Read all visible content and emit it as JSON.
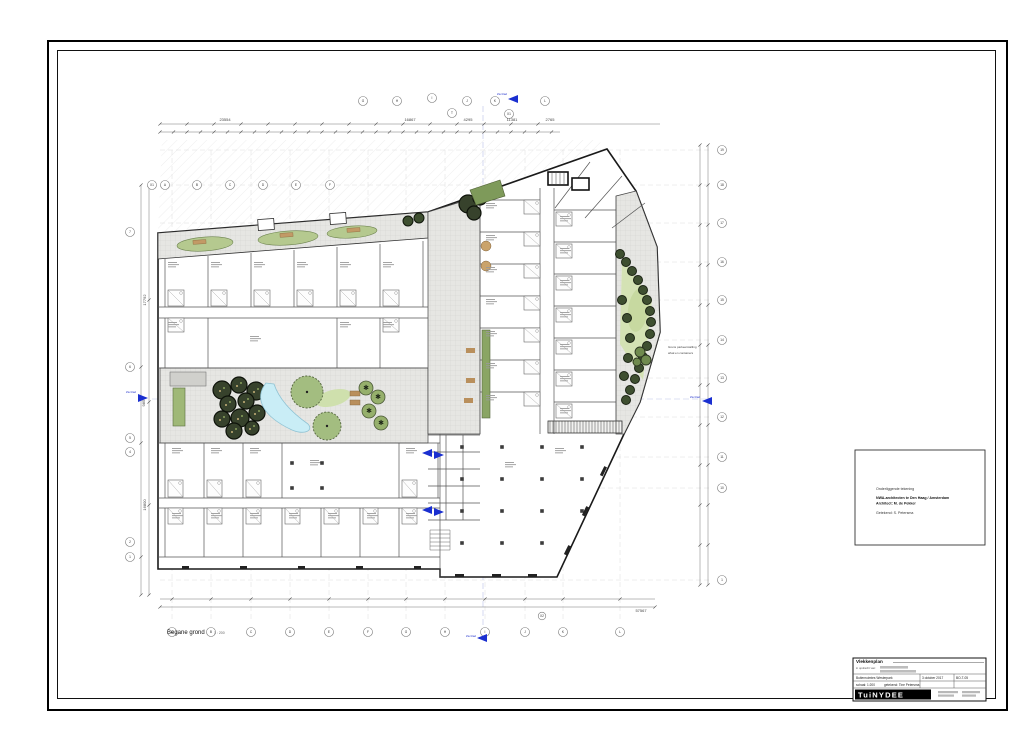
{
  "sheet": {
    "plan_title": "Begane grond",
    "plan_scale": "1 : 200"
  },
  "note_box": {
    "line1": "Onderliggende tekening",
    "line2": "NWA-architecten te Den Haag / Amsterdam",
    "line3": "Architect: M. de Pekker",
    "line4": "Getekend: S. Petersma"
  },
  "title_block": {
    "title": "Vlekkenplan",
    "client_label": "in opdracht van:",
    "project": "Buitenruimtes Westerpark",
    "date": "3 oktober 2017",
    "sheet_no": "BO-T-05",
    "scale_label": "schaal: 1:200",
    "drawn_label": "getekend: Tine Petersma",
    "logo": "TuiNYDEE"
  },
  "annotations": {
    "zie_blad": "Zie blad",
    "parkeer_line1": "Grens parkeerstalling",
    "parkeer_line2": "afval en containers"
  },
  "dimensions": {
    "top": [
      "23554",
      "16867",
      "4295",
      "11381",
      "2765"
    ],
    "bottom_total": "57567",
    "left": [
      "17792",
      "9850",
      "16800"
    ]
  },
  "grid": {
    "top": [
      "G",
      "H",
      "I",
      "T",
      "J",
      "K",
      "X1",
      "L"
    ],
    "upper_left": [
      "X1",
      "A",
      "B",
      "C",
      "D",
      "E",
      "F"
    ],
    "bottom": [
      "A",
      "B",
      "C",
      "D",
      "E",
      "F",
      "G",
      "H",
      "I",
      "J",
      "K",
      "L",
      "X2"
    ],
    "left": [
      "7",
      "6",
      "5",
      "4",
      "2",
      "1"
    ],
    "right": [
      "19",
      "18",
      "17",
      "16",
      "15",
      "14",
      "13",
      "12",
      "11",
      "10",
      "1"
    ]
  }
}
